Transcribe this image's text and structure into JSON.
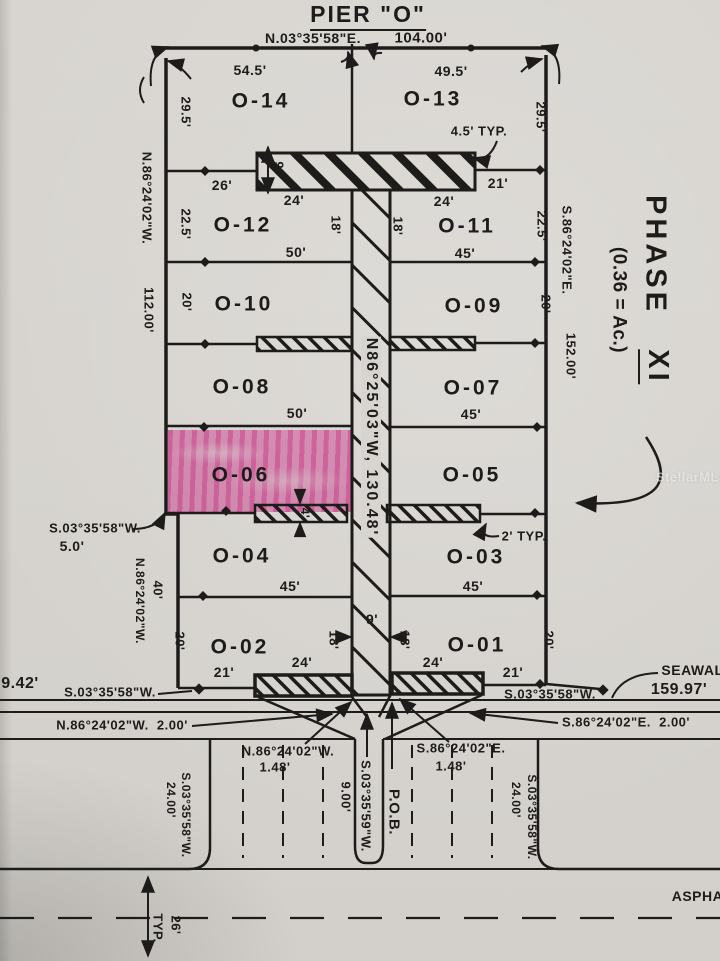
{
  "document": {
    "title": "PIER \"O\" — Survey Plat, Phase XI",
    "watermark": "StellarMLS"
  },
  "colors": {
    "paper": "#d8d5d0",
    "ink": "#1d1c1b",
    "highlight": "#ee54b0"
  },
  "phase": {
    "name": "PHASE XI",
    "area": "(0.36 = Ac.)"
  },
  "highlighted_lot": "O-06",
  "labels": [
    {
      "n": "pier-title",
      "t": "PIER \"O\"",
      "x": 368,
      "y": 17,
      "s": 23,
      "r": 0,
      "u": true,
      "k": "title"
    },
    {
      "n": "top-bearing",
      "t": "N.03°35'58\"E.",
      "x": 313,
      "y": 38,
      "s": 14,
      "r": 0
    },
    {
      "n": "top-distance",
      "t": "104.00'",
      "x": 421,
      "y": 38,
      "s": 15,
      "r": 0
    },
    {
      "n": "width-o14",
      "t": "54.5'",
      "x": 250,
      "y": 70,
      "s": 14,
      "r": 0
    },
    {
      "n": "width-o13",
      "t": "49.5'",
      "x": 451,
      "y": 71,
      "s": 14,
      "r": 0
    },
    {
      "n": "lot-o14",
      "t": "O-14",
      "x": 261,
      "y": 101,
      "s": 21,
      "r": 0,
      "k": "lot"
    },
    {
      "n": "lot-o13",
      "t": "O-13",
      "x": 433,
      "y": 99,
      "s": 21,
      "r": 0,
      "k": "lot"
    },
    {
      "n": "typ-45",
      "t": "4.5' TYP.",
      "x": 479,
      "y": 131,
      "s": 13,
      "r": 0
    },
    {
      "n": "dim-26",
      "t": "26'",
      "x": 222,
      "y": 185,
      "s": 14,
      "r": 0
    },
    {
      "n": "dim-21-top",
      "t": "21'",
      "x": 498,
      "y": 183,
      "s": 14,
      "r": 0
    },
    {
      "n": "dim-24-tl",
      "t": "24'",
      "x": 294,
      "y": 200,
      "s": 14,
      "r": 0
    },
    {
      "n": "dim-24-tr",
      "t": "24'",
      "x": 444,
      "y": 201,
      "s": 14,
      "r": 0
    },
    {
      "n": "lot-o12",
      "t": "O-12",
      "x": 243,
      "y": 225,
      "s": 21,
      "r": 0,
      "k": "lot"
    },
    {
      "n": "lot-o11",
      "t": "O-11",
      "x": 467,
      "y": 226,
      "s": 21,
      "r": 0,
      "k": "lot"
    },
    {
      "n": "dim-50-1",
      "t": "50'",
      "x": 296,
      "y": 252,
      "s": 14,
      "r": 0
    },
    {
      "n": "dim-45-1",
      "t": "45'",
      "x": 465,
      "y": 253,
      "s": 14,
      "r": 0
    },
    {
      "n": "lot-o10",
      "t": "O-10",
      "x": 244,
      "y": 304,
      "s": 21,
      "r": 0,
      "k": "lot"
    },
    {
      "n": "lot-o09",
      "t": "O-09",
      "x": 474,
      "y": 306,
      "s": 21,
      "r": 0,
      "k": "lot"
    },
    {
      "n": "lot-o08",
      "t": "O-08",
      "x": 242,
      "y": 387,
      "s": 21,
      "r": 0,
      "k": "lot"
    },
    {
      "n": "lot-o07",
      "t": "O-07",
      "x": 473,
      "y": 388,
      "s": 21,
      "r": 0,
      "k": "lot"
    },
    {
      "n": "dim-50-2",
      "t": "50'",
      "x": 297,
      "y": 413,
      "s": 14,
      "r": 0
    },
    {
      "n": "dim-45-2",
      "t": "45'",
      "x": 471,
      "y": 414,
      "s": 14,
      "r": 0
    },
    {
      "n": "lot-o06",
      "t": "O-06",
      "x": 241,
      "y": 475,
      "s": 21,
      "r": 0,
      "k": "lot"
    },
    {
      "n": "lot-o05",
      "t": "O-05",
      "x": 472,
      "y": 475,
      "s": 21,
      "r": 0,
      "k": "lot"
    },
    {
      "n": "typ-2",
      "t": "2' TYP.",
      "x": 524,
      "y": 536,
      "s": 13,
      "r": 0
    },
    {
      "n": "jog-bearing-label",
      "t": "S.03°35'58\"W.",
      "x": 95,
      "y": 528,
      "s": 13,
      "r": 0
    },
    {
      "n": "jog-distance",
      "t": "5.0'",
      "x": 72,
      "y": 546,
      "s": 14,
      "r": 0
    },
    {
      "n": "lot-o04",
      "t": "O-04",
      "x": 242,
      "y": 556,
      "s": 21,
      "r": 0,
      "k": "lot"
    },
    {
      "n": "lot-o03",
      "t": "O-03",
      "x": 476,
      "y": 557,
      "s": 21,
      "r": 0,
      "k": "lot"
    },
    {
      "n": "dim-45-3",
      "t": "45'",
      "x": 290,
      "y": 586,
      "s": 14,
      "r": 0
    },
    {
      "n": "dim-45-4",
      "t": "45'",
      "x": 473,
      "y": 586,
      "s": 14,
      "r": 0
    },
    {
      "n": "dim-9-width",
      "t": "9'",
      "x": 372,
      "y": 619,
      "s": 14,
      "r": 0
    },
    {
      "n": "lot-o02",
      "t": "O-02",
      "x": 240,
      "y": 647,
      "s": 21,
      "r": 0,
      "k": "lot"
    },
    {
      "n": "lot-o01",
      "t": "O-01",
      "x": 477,
      "y": 645,
      "s": 21,
      "r": 0,
      "k": "lot"
    },
    {
      "n": "dim-24-bl",
      "t": "24'",
      "x": 302,
      "y": 662,
      "s": 14,
      "r": 0
    },
    {
      "n": "dim-24-br",
      "t": "24'",
      "x": 433,
      "y": 662,
      "s": 14,
      "r": 0
    },
    {
      "n": "dim-21-bl",
      "t": "21'",
      "x": 224,
      "y": 672,
      "s": 14,
      "r": 0
    },
    {
      "n": "dim-21-br",
      "t": "21'",
      "x": 513,
      "y": 672,
      "s": 14,
      "r": 0
    },
    {
      "n": "seawall-label",
      "t": "SEAWALL",
      "x": 697,
      "y": 670,
      "s": 14,
      "r": 0
    },
    {
      "n": "seawall-distance",
      "t": "159.97'",
      "x": 679,
      "y": 690,
      "s": 16,
      "r": 0
    },
    {
      "n": "sw-bearing-left",
      "t": "S.03°35'58\"W.",
      "x": 110,
      "y": 692,
      "s": 13,
      "r": 0
    },
    {
      "n": "sw-bearing-right",
      "t": "S.03°35'58\"W.",
      "x": 550,
      "y": 694,
      "s": 13,
      "r": 0
    },
    {
      "n": "dist-942",
      "t": "9.42'",
      "x": 20,
      "y": 684,
      "s": 16,
      "r": 0
    },
    {
      "n": "bearing-2ft-left",
      "t": "N.86°24'02\"W.  2.00'",
      "x": 122,
      "y": 725,
      "s": 13,
      "r": 0
    },
    {
      "n": "bearing-2ft-right",
      "t": "S.86°24'02\"E.  2.00'",
      "x": 626,
      "y": 722,
      "s": 13,
      "r": 0
    },
    {
      "n": "bearing-148-left",
      "t": "N.86°24'02\"W.",
      "x": 288,
      "y": 751,
      "s": 13,
      "r": 0
    },
    {
      "n": "dist-148-left",
      "t": "1.48'",
      "x": 275,
      "y": 767,
      "s": 13,
      "r": 0
    },
    {
      "n": "bearing-148-right",
      "t": "S.86°24'02\"E.",
      "x": 461,
      "y": 748,
      "s": 13,
      "r": 0
    },
    {
      "n": "dist-148-right",
      "t": "1.48'",
      "x": 451,
      "y": 766,
      "s": 13,
      "r": 0
    },
    {
      "n": "asphalt-label",
      "t": "ASPHALT",
      "x": 706,
      "y": 896,
      "s": 14,
      "r": 0
    },
    {
      "n": "depth-295-left",
      "t": "29.5'",
      "x": 186,
      "y": 112,
      "s": 13,
      "r": 90
    },
    {
      "n": "depth-295-right",
      "t": "29.5'",
      "x": 541,
      "y": 117,
      "s": 13,
      "r": 90
    },
    {
      "n": "depth-225-left",
      "t": "22.5'",
      "x": 186,
      "y": 224,
      "s": 13,
      "r": 90
    },
    {
      "n": "depth-225-right",
      "t": "22.5'",
      "x": 542,
      "y": 226,
      "s": 13,
      "r": 90
    },
    {
      "n": "depth-20-left-1",
      "t": "20'",
      "x": 187,
      "y": 302,
      "s": 13,
      "r": 90
    },
    {
      "n": "depth-20-right-1",
      "t": "20'",
      "x": 546,
      "y": 304,
      "s": 13,
      "r": 90
    },
    {
      "n": "side-bearing-left",
      "t": "N.86°24'02\"W.",
      "x": 147,
      "y": 198,
      "s": 13,
      "r": 90
    },
    {
      "n": "side-distance-left",
      "t": "112.00'",
      "x": 149,
      "y": 310,
      "s": 13,
      "r": 90
    },
    {
      "n": "side-bearing-right",
      "t": "S.86°24'02\"E.",
      "x": 567,
      "y": 250,
      "s": 13,
      "r": 90
    },
    {
      "n": "side-distance-right",
      "t": "152.00'",
      "x": 571,
      "y": 356,
      "s": 13,
      "r": 90
    },
    {
      "n": "phase-word",
      "t": "PHASE",
      "x": 655,
      "y": 255,
      "s": 29,
      "r": 90,
      "k": "phz"
    },
    {
      "n": "phase-numeral",
      "t": "XI",
      "x": 655,
      "y": 367,
      "s": 29,
      "r": 90,
      "u": true,
      "k": "phz"
    },
    {
      "n": "phase-area",
      "t": "(0.36 = Ac.)",
      "x": 619,
      "y": 300,
      "s": 19,
      "r": 90
    },
    {
      "n": "walkway-bearing",
      "t": "N86°25'03\"W, 130.48'",
      "x": 371,
      "y": 437,
      "s": 16,
      "r": 90,
      "k": "bgp"
    },
    {
      "n": "dim-18-tl",
      "t": "18'",
      "x": 336,
      "y": 225,
      "s": 13,
      "r": 90
    },
    {
      "n": "dim-18-tr",
      "t": "18'",
      "x": 398,
      "y": 226,
      "s": 13,
      "r": 90
    },
    {
      "n": "dim-18-bl",
      "t": "18'",
      "x": 334,
      "y": 640,
      "s": 13,
      "r": 90
    },
    {
      "n": "dim-18-br",
      "t": "18'",
      "x": 405,
      "y": 640,
      "s": 13,
      "r": 90
    },
    {
      "n": "dim-9-strip",
      "t": "9'",
      "x": 279,
      "y": 167,
      "s": 13,
      "r": 90
    },
    {
      "n": "dim-4",
      "t": "4'",
      "x": 305,
      "y": 513,
      "s": 12,
      "r": 90
    },
    {
      "n": "dim-40",
      "t": "40'",
      "x": 158,
      "y": 590,
      "s": 13,
      "r": 90
    },
    {
      "n": "jog-side-bearing",
      "t": "N.86°24'02\"W.",
      "x": 140,
      "y": 601,
      "s": 12,
      "r": 90
    },
    {
      "n": "depth-20-left-2",
      "t": "20'",
      "x": 180,
      "y": 641,
      "s": 13,
      "r": 90
    },
    {
      "n": "depth-20-right-2",
      "t": "20'",
      "x": 549,
      "y": 640,
      "s": 13,
      "r": 90
    },
    {
      "n": "lot-line-bearing-left",
      "t": "S.03°35'58\"W.",
      "x": 186,
      "y": 815,
      "s": 12,
      "r": 90
    },
    {
      "n": "lot-line-dist-left",
      "t": "24.00'",
      "x": 171,
      "y": 800,
      "s": 12,
      "r": 90
    },
    {
      "n": "lot-line-bearing-right",
      "t": "S.03°35'58\"W.",
      "x": 532,
      "y": 817,
      "s": 12,
      "r": 90
    },
    {
      "n": "lot-line-dist-right",
      "t": "24.00'",
      "x": 516,
      "y": 800,
      "s": 12,
      "r": 90
    },
    {
      "n": "pob-bearing",
      "t": "S.03°35'59\"W.",
      "x": 366,
      "y": 806,
      "s": 13,
      "r": 90
    },
    {
      "n": "pob-distance",
      "t": "9.00'",
      "x": 346,
      "y": 797,
      "s": 13,
      "r": 90
    },
    {
      "n": "pob-label",
      "t": "P.O.B.",
      "x": 394,
      "y": 812,
      "s": 15,
      "r": 90
    },
    {
      "n": "dim-26-typ",
      "t": "26'",
      "x": 176,
      "y": 925,
      "s": 13,
      "r": 90
    },
    {
      "n": "dim-26-typ-word",
      "t": "TYP.",
      "x": 158,
      "y": 928,
      "s": 13,
      "r": 90
    }
  ]
}
